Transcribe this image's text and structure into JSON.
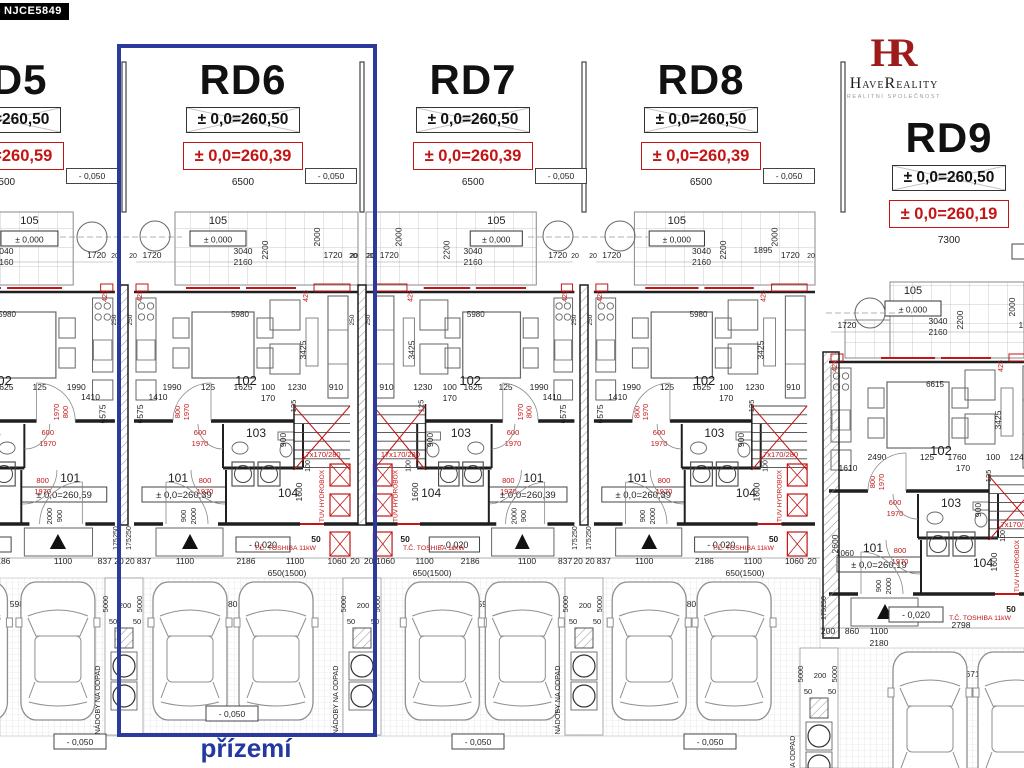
{
  "badge": "NJCE5849",
  "logo": {
    "monogram": "HR",
    "name_h": "H",
    "name_ave": "AVE",
    "name_r": "R",
    "name_eality": "EALITY",
    "tagline": "REALITNÍ SPOLEČNOST"
  },
  "highlight_label": "přízemí",
  "colors": {
    "blue": "#2b3a9b",
    "red": "#c41414",
    "line": "#1f1f1f",
    "mid": "#666666",
    "light": "#8f8f8f"
  },
  "units": [
    {
      "name": "RD5",
      "elev_black": "± 0,0=260,50",
      "elev_red": "± 0,0=260,59",
      "level": "- 0,050",
      "width_dim": "6500",
      "inner_elev": "± 0,0=260,59"
    },
    {
      "name": "RD6",
      "elev_black": "± 0,0=260,50",
      "elev_red": "± 0,0=260,39",
      "level": "- 0,050",
      "width_dim": "6500",
      "inner_elev": "± 0,0=260,39"
    },
    {
      "name": "RD7",
      "elev_black": "± 0,0=260,50",
      "elev_red": "± 0,0=260,39",
      "level": "- 0,050",
      "width_dim": "6500",
      "inner_elev": "± 0,0=260,39"
    },
    {
      "name": "RD8",
      "elev_black": "± 0,0=260,50",
      "elev_red": "± 0,0=260,39",
      "level": "- 0,050",
      "width_dim": "6500",
      "inner_elev": "± 0,0=260,39"
    },
    {
      "name": "RD9",
      "elev_black": "± 0,0=260,50",
      "elev_red": "± 0,0=260,19",
      "level": "- 0,050",
      "width_dim": "7300",
      "inner_elev": "± 0,0=260,19"
    }
  ],
  "rooms": {
    "r101": "101",
    "r102": "102",
    "r103": "103",
    "r104": "104",
    "r105": "105",
    "terrace_elev": "± 0,000"
  },
  "labels": {
    "stairs": "17x170/280",
    "tuv": "TUV HYDROBOX",
    "toshiba": "T.Č. TOSHIBA 11kW",
    "entry_level": "- 0,020",
    "ground_level": "- 0,050",
    "bins": "NÁDOBY NA ODPAD",
    "bin_single": "NÁDOBA NA ODPAD"
  },
  "dims": {
    "terrace_left": "1720",
    "terrace_mid_a": "3040",
    "terrace_mid_b": "2160",
    "terrace_right": "1720",
    "t2200": "2200",
    "t2000": "2000",
    "d20": "20",
    "d425": "425",
    "d250": "250",
    "d1895": "1895",
    "room_w": "5980",
    "room_d": "3425",
    "row": [
      "1990",
      "125",
      "1625",
      "100",
      "1230",
      "910"
    ],
    "d170": "170",
    "d1410": "1410",
    "d6575": "6575",
    "d125": "125",
    "d900": "900",
    "d100": "100",
    "d1600": "1600",
    "door600": [
      "600",
      "1970"
    ],
    "door800": [
      "800",
      "1970"
    ],
    "door900": [
      "900",
      "2000"
    ],
    "entry_row": [
      "20",
      "837",
      "1100",
      "2186",
      "1100",
      "1060",
      "20"
    ],
    "entry_sub": "650(1500)",
    "d50": "50",
    "d175": "175",
    "d5000": "5000",
    "d200": "200",
    "park_w": "5980",
    "d3000": "3000",
    "rd9": {
      "room_w": "6615",
      "row": [
        "2490",
        "125",
        "1760",
        "100",
        "1240"
      ],
      "d1610": "1610",
      "car1": "2798",
      "car2": "6715",
      "e200": "200",
      "e860": "860",
      "e1100": "1100",
      "e2180": "2180",
      "d2600": "2600",
      "d1060": "1060"
    }
  }
}
